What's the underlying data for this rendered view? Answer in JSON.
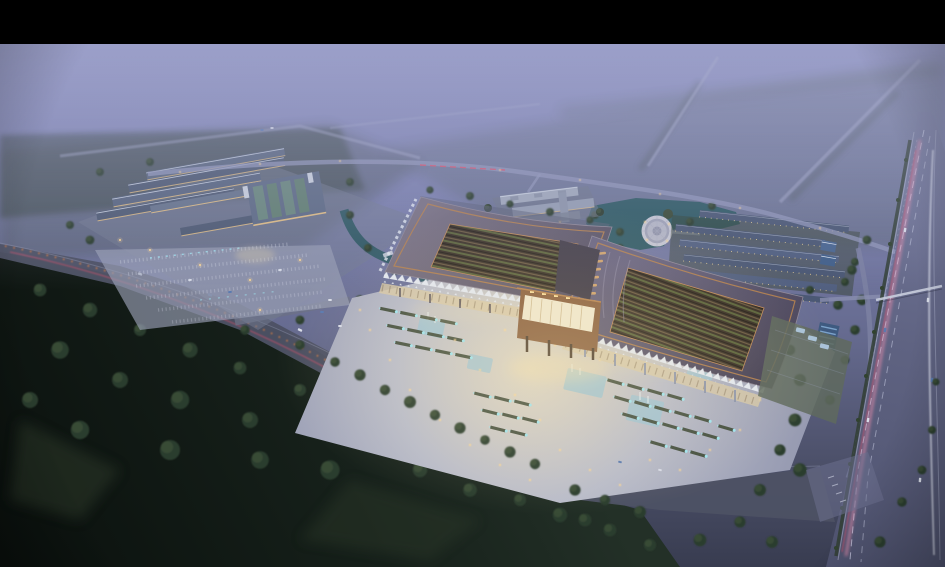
{
  "meta": {
    "title": "Aerial dusk rendering of a traditional-roofed market and exhibition complex",
    "type": "architectural-visualization",
    "visible_text": "none"
  },
  "palette": {
    "black": "#000000",
    "skyTop": "#8E92C3",
    "skyMid": "#7A7FAC",
    "skyLow": "#666B90",
    "duskDeep": "#383C50",
    "mistHaze": "#A9ADCF",
    "fieldGreen": "#46523F",
    "forestDark": "#16201A",
    "forestDeep": "#0A100D",
    "treeMid": "#2C3C2E",
    "treeLight": "#3E5038",
    "grass": "#2E3A2C",
    "roadMist": "#A6AACB",
    "asphalt": "#4D5164",
    "highway": "#5F6382",
    "laneLine": "#CDD2E8",
    "trailPink": "#EF8FAE",
    "trailRed": "#E0506A",
    "trailOrange": "#E8823F",
    "headlightWhite": "#E9EDF9",
    "plaza": "#B9BCCA",
    "plazaGlow": "#DED6C4",
    "plazaEdge": "#9296AE",
    "roofLeft": "#6E6778",
    "roofRight": "#5C5975",
    "roofDeep": "#4A4558",
    "roofTrim": "#B5814F",
    "courtDark": "#382F26",
    "courtGreen": "#59623A",
    "courtBeam": "#6B5A42",
    "truss": "#E3E8F1",
    "gateWood": "#8A5F3E",
    "gateGlow": "#F0E8D0",
    "windowWarm": "#F7DC9A",
    "lampWarm": "#FFD993",
    "fountainCyan": "#9FE4F0",
    "poolBlue": "#9CC3D4",
    "waterTeal": "#2F5A64",
    "slate": "#4E5A72",
    "slateLight": "#8593AD",
    "ridge": "#DCE3EF",
    "facadeWarm": "#E5C084",
    "rowRoof": "#4B5874",
    "solarBlue": "#3E5A80",
    "terrace": "#5F6A5E",
    "litWall": "#D9C9A6"
  },
  "scene": {
    "letterbox_top_px": 44,
    "time_of_day": "dusk",
    "elements": [
      {
        "name": "dusk-mist-sky",
        "desc": "lavender haze fading to distant fields"
      },
      {
        "name": "mist-roads",
        "desc": "faint roads receding into fog, top area"
      },
      {
        "name": "left-market-complex",
        "desc": "cluster of long lit warehouse buildings with parking lot"
      },
      {
        "name": "office-building",
        "desc": "white slab office block, top center"
      },
      {
        "name": "lake",
        "desc": "teal pond right of office building"
      },
      {
        "name": "circular-fountain-plaza",
        "desc": "round plaza beside lake"
      },
      {
        "name": "dormitory-rows",
        "desc": "six parallel row buildings, right of circle"
      },
      {
        "name": "west-hall",
        "desc": "large curved-eave hall with glowing courtyard"
      },
      {
        "name": "east-hall",
        "desc": "second curved-eave hall with glowing courtyard"
      },
      {
        "name": "central-gate",
        "desc": "glowing gate pavilion between halls"
      },
      {
        "name": "festival-plaza",
        "desc": "bright paved plaza with pools and planted parking strips"
      },
      {
        "name": "front-avenue",
        "desc": "diagonal road with warm street lights and light trails"
      },
      {
        "name": "highway",
        "desc": "wide highway on right with pink and white light trails"
      },
      {
        "name": "forest",
        "desc": "dark woodland filling bottom left"
      },
      {
        "name": "letterbox-bar",
        "desc": "black bar across top"
      }
    ],
    "counts": {
      "halls": 2,
      "dormitory_rows": 6,
      "reflecting_pools": 5,
      "eave_skylight_slots": 17
    }
  }
}
